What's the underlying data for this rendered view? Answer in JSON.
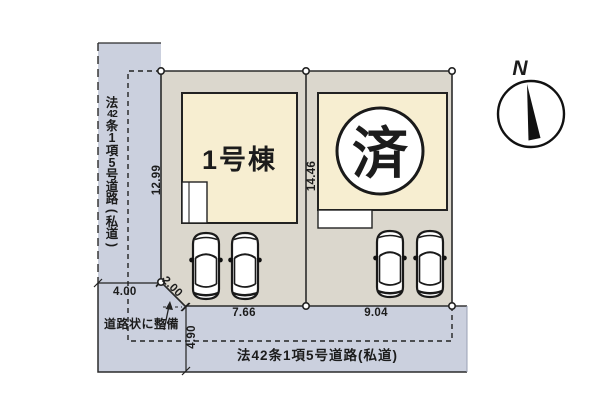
{
  "plan": {
    "colors": {
      "road": "#cbd0de",
      "plot": "#dbd7cd",
      "building": "#f7eed1",
      "line": "#2b2b2b",
      "ink": "#1c1c1c"
    },
    "left_road": {
      "label": "法42条1項5号道路(私道)",
      "tokens": [
        "法",
        "42",
        "条",
        "1",
        "項",
        "5",
        "号",
        "道",
        "路",
        "(",
        "私",
        "道",
        ")"
      ]
    },
    "bottom_road": {
      "label": "法42条1項5号道路(私道)"
    },
    "note": {
      "label": "道路状に整備"
    },
    "buildings": {
      "unit1": {
        "label": "1号棟"
      },
      "unit2": {
        "status": "済"
      }
    },
    "dimensions": {
      "west_boundary": "12.99",
      "center_boundary": "14.46",
      "plot1_frontage": "7.66",
      "plot2_frontage": "9.04",
      "west_road_width": "4.00",
      "corner_cut": "2.00",
      "south_road_width": "4.90"
    },
    "compass": {
      "label": "N"
    }
  }
}
